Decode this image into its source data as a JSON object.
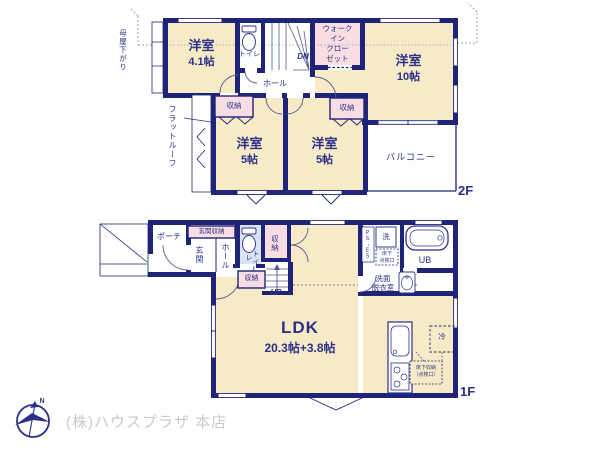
{
  "colors": {
    "wall_navy": "#1f2478",
    "label_navy": "#2c3187",
    "room_cream": "#f6eac7",
    "closet_pink": "#f8dde2",
    "toilet_blue": "#d9e5f3",
    "logo_gray": "#c9c9c9"
  },
  "floor2": {
    "floor_label": "2F",
    "room_yoshitsu_41": {
      "name": "洋室",
      "size": "4.1帖"
    },
    "toilet_label": "トイレ",
    "stairs_label": "DN",
    "hall_label": "ホール",
    "wic_label": "ウォーク\nイン\nクロー\nゼット",
    "room_yoshitsu_10": {
      "name": "洋室",
      "size": "10帖"
    },
    "closet_left_label": "収納",
    "closet_right_label": "収納",
    "room_5_left": {
      "name": "洋室",
      "size": "5帖"
    },
    "room_5_right": {
      "name": "洋室",
      "size": "5帖"
    },
    "balcony_label": "バルコニー",
    "annotation_moyasagari": "母屋下がり",
    "annotation_flatroof": "フラットルーフ"
  },
  "floor1": {
    "floor_label": "1F",
    "porch_label": "ポーチ",
    "genkan_storage_label": "玄関収納",
    "genkan_label": "玄関",
    "hall_label": "ホール",
    "toilet_label": "トイレ",
    "closet_upper_label": "収納",
    "closet_lower_label": "収納",
    "stairs_label": "UP",
    "ps_es_label": "PS・ES",
    "washer_label": "洗",
    "inspection_hatch_label": "床下\n点検口",
    "washroom_label": "洗面\n脱衣室",
    "bath_label": "UB",
    "ldk": {
      "name": "LDK",
      "size": "20.3帖+3.8帖"
    },
    "fridge_label": "冷",
    "floor_storage_label": "床下収納\n（点検口）"
  },
  "footer": {
    "company": "(株)ハウスプラザ 本店",
    "compass_n": "N"
  }
}
